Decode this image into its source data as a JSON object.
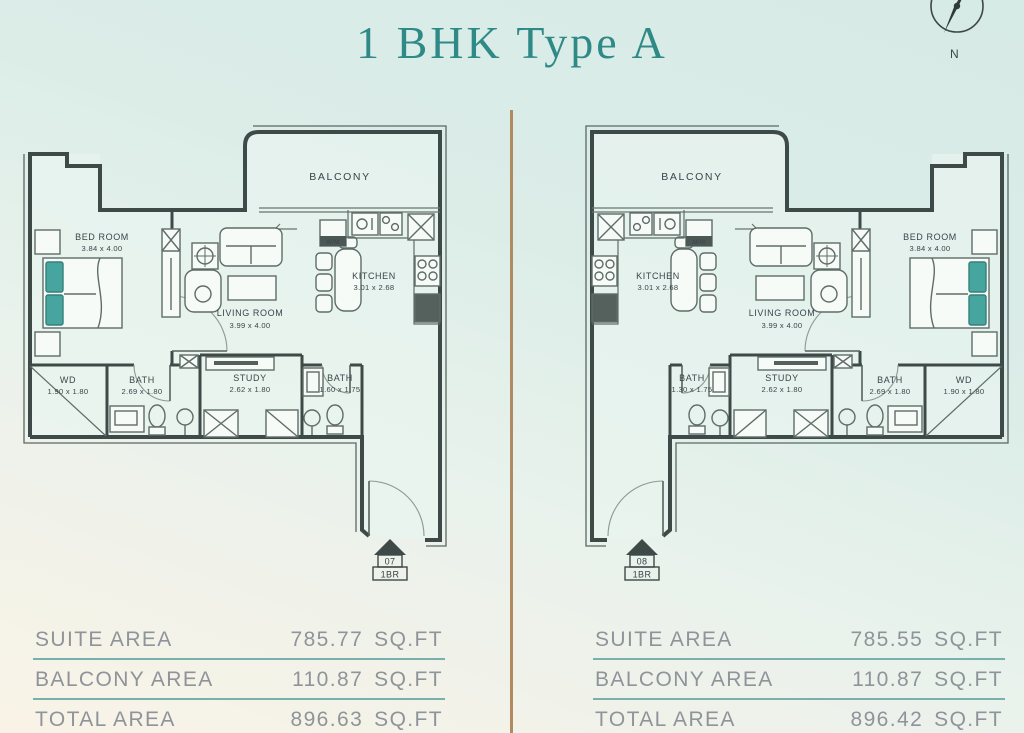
{
  "title": "1 BHK Type A",
  "compass": {
    "label": "N"
  },
  "accent_colors": {
    "title_teal": "#2f8a87",
    "table_divider_teal": "#79b0ad",
    "center_divider_tan": "#b28a5f",
    "pillow_teal": "#46a69f"
  },
  "plans": [
    {
      "side": "left",
      "unit_number": "07",
      "unit_type": "1BR",
      "rooms": {
        "balcony": {
          "name": "BALCONY"
        },
        "bedroom": {
          "name": "BED ROOM",
          "dims": "3.84 x 4.00"
        },
        "living": {
          "name": "LIVING ROOM",
          "dims": "3.99 x 4.00"
        },
        "kitchen": {
          "name": "KITCHEN",
          "dims": "3.01 x 2.68"
        },
        "washer": {
          "name": "W/M"
        },
        "wd": {
          "name": "WD",
          "dims": "1.90 x 1.80"
        },
        "bath_main": {
          "name": "BATH",
          "dims": "2.69 x 1.80"
        },
        "study": {
          "name": "STUDY",
          "dims": "2.62 x 1.80"
        },
        "bath_guest": {
          "name": "BATH",
          "dims": "1.60 x 1.75"
        }
      },
      "areas": {
        "suite": {
          "label": "SUITE AREA",
          "value": "785.77",
          "unit": "SQ.FT"
        },
        "balcony": {
          "label": "BALCONY AREA",
          "value": "110.87",
          "unit": "SQ.FT"
        },
        "total": {
          "label": "TOTAL AREA",
          "value": "896.63",
          "unit": "SQ.FT"
        }
      }
    },
    {
      "side": "right",
      "unit_number": "08",
      "unit_type": "1BR",
      "rooms": {
        "balcony": {
          "name": "BALCONY"
        },
        "bedroom": {
          "name": "BED ROOM",
          "dims": "3.84 x 4.00"
        },
        "living": {
          "name": "LIVING ROOM",
          "dims": "3.99 x 4.00"
        },
        "kitchen": {
          "name": "KITCHEN",
          "dims": "3.01 x 2.68"
        },
        "washer": {
          "name": "M/W"
        },
        "wd": {
          "name": "WD",
          "dims": "1.90 x 1.80"
        },
        "bath_main": {
          "name": "BATH",
          "dims": "2.69 x 1.80"
        },
        "study": {
          "name": "STUDY",
          "dims": "2.62 x 1.80"
        },
        "bath_guest": {
          "name": "BATH",
          "dims": "1.30 x 1.75"
        }
      },
      "areas": {
        "suite": {
          "label": "SUITE AREA",
          "value": "785.55",
          "unit": "SQ.FT"
        },
        "balcony": {
          "label": "BALCONY AREA",
          "value": "110.87",
          "unit": "SQ.FT"
        },
        "total": {
          "label": "TOTAL AREA",
          "value": "896.42",
          "unit": "SQ.FT"
        }
      }
    }
  ]
}
